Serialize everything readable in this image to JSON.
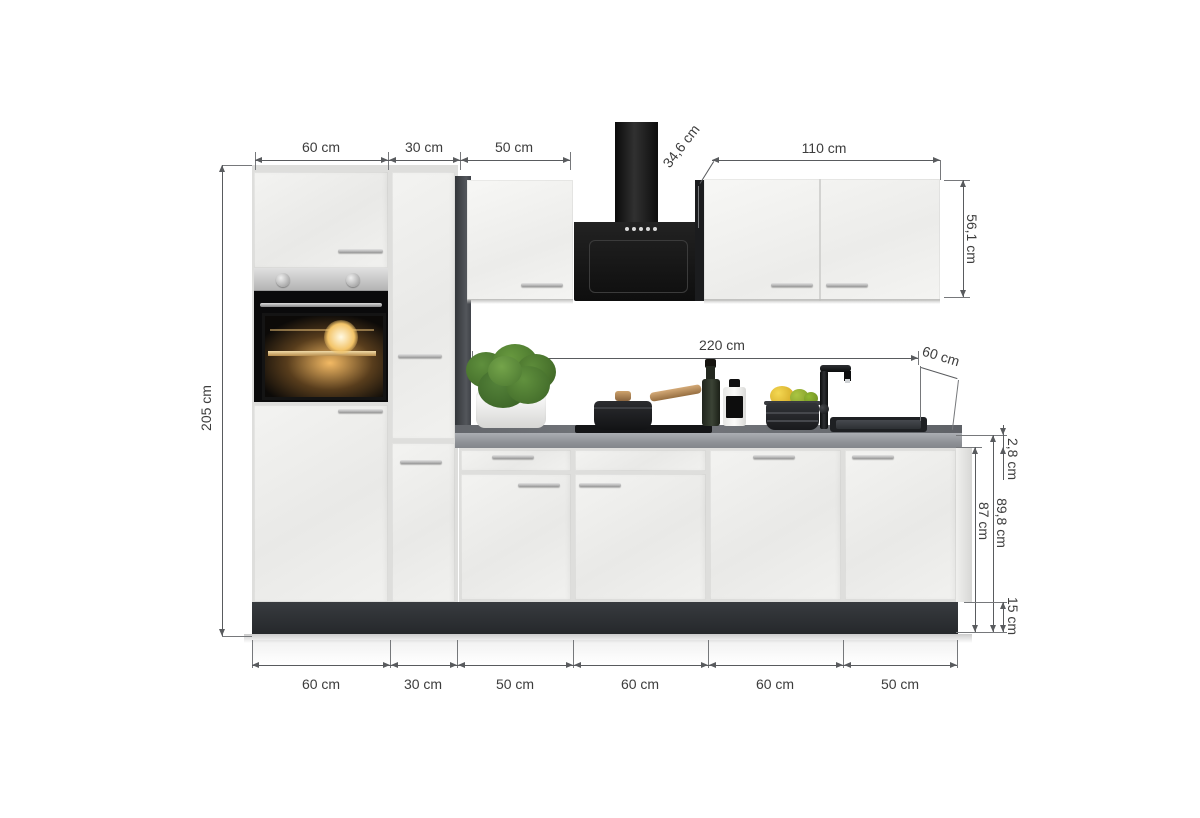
{
  "dimensions": {
    "top_widths": [
      "60 cm",
      "30 cm",
      "50 cm"
    ],
    "wall_cabinet_depth": "34,6 cm",
    "wall_cabinet_width": "110 cm",
    "wall_cabinet_height": "56,1 cm",
    "total_height": "205 cm",
    "worktop_run_width": "220 cm",
    "worktop_depth": "60 cm",
    "worktop_thickness": "2,8 cm",
    "worktop_height": "89,8 cm",
    "base_cabinet_height": "87 cm",
    "plinth_height": "15 cm",
    "bottom_widths": [
      "60 cm",
      "30 cm",
      "50 cm",
      "60 cm",
      "60 cm",
      "50 cm"
    ]
  },
  "colors": {
    "dimension_line": "#595b5e",
    "dimension_text": "#3d3d3d",
    "cabinet_front_white": "#efefed",
    "anthracite_panel": "#3a3d41",
    "plinth_anthracite": "#303338",
    "worktop_concrete_gray": "#8f9297",
    "hood_black": "#161616",
    "stainless_steel": "#c0c0c0",
    "plant_green": "#4e7a33",
    "lemon_yellow": "#e8c437",
    "lime_green": "#9ab636",
    "wood_handle": "#b98a55",
    "oven_glow_amber": "#c78f3c"
  }
}
